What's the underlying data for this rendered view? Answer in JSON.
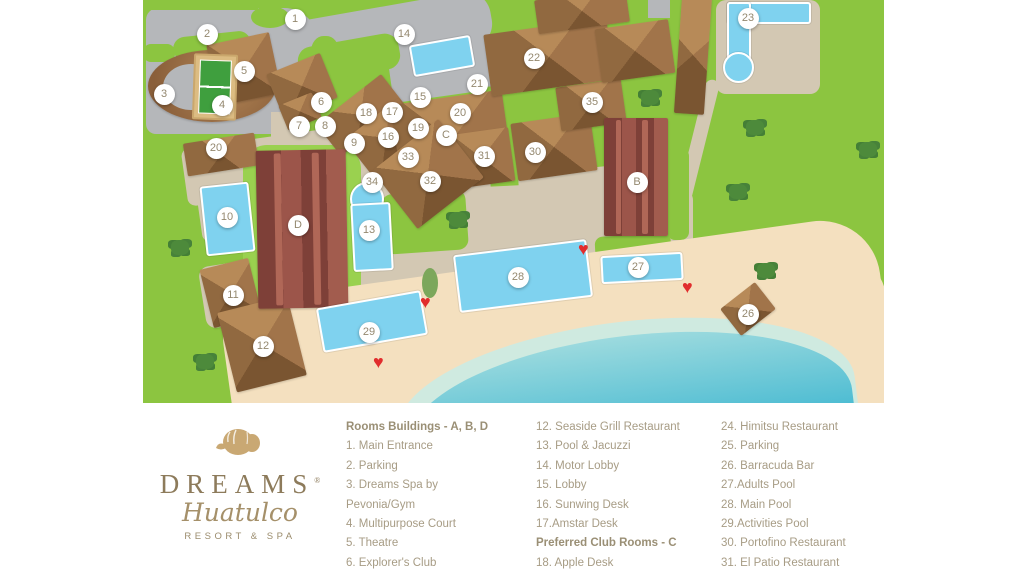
{
  "logo": {
    "brand": "DREAMS",
    "registered": "®",
    "script": "Huatulco",
    "tagline": "RESORT & SPA",
    "shell_icon_color": "#c9a873"
  },
  "legend": {
    "columns": [
      {
        "rows": [
          {
            "t": "h",
            "text": "Rooms Buildings - A, B, D"
          },
          {
            "t": "i",
            "text": "1. Main Entrance"
          },
          {
            "t": "i",
            "text": "2. Parking"
          },
          {
            "t": "i",
            "text": "3. Dreams Spa by"
          },
          {
            "t": "i",
            "text": "Pevonia/Gym"
          },
          {
            "t": "i",
            "text": "4. Multipurpose Court"
          },
          {
            "t": "i",
            "text": "5. Theatre"
          },
          {
            "t": "i",
            "text": "6. Explorer's Club"
          }
        ]
      },
      {
        "rows": [
          {
            "t": "i",
            "text": "12. Seaside Grill Restaurant"
          },
          {
            "t": "i",
            "text": "13. Pool & Jacuzzi"
          },
          {
            "t": "i",
            "text": "14. Motor Lobby"
          },
          {
            "t": "i",
            "text": "15. Lobby"
          },
          {
            "t": "i",
            "text": "16. Sunwing Desk"
          },
          {
            "t": "i",
            "text": "17.Amstar Desk"
          },
          {
            "t": "h",
            "text": "Preferred Club Rooms - C"
          },
          {
            "t": "i",
            "text": "18. Apple Desk"
          },
          {
            "t": "i",
            "text": "19. Rendezvous Bar"
          }
        ]
      },
      {
        "rows": [
          {
            "t": "i",
            "text": "24. Himitsu Restaurant"
          },
          {
            "t": "i",
            "text": "25. Parking"
          },
          {
            "t": "i",
            "text": "26. Barracuda Bar"
          },
          {
            "t": "i",
            "text": "27.Adults Pool"
          },
          {
            "t": "i",
            "text": "28. Main Pool"
          },
          {
            "t": "i",
            "text": "29.Activities Pool"
          },
          {
            "t": "i",
            "text": "30. Portofino Restaurant"
          },
          {
            "t": "i",
            "text": "31. El Patio Restaurant"
          },
          {
            "t": "i",
            "text": "32. World Café Restaurant"
          }
        ]
      }
    ]
  },
  "map": {
    "note": "marker coordinates are relative to map area (left 143, top 0)",
    "markers": [
      {
        "label": "1",
        "x": 152,
        "y": 19
      },
      {
        "label": "2",
        "x": 64,
        "y": 34
      },
      {
        "label": "3",
        "x": 21,
        "y": 94
      },
      {
        "label": "4",
        "x": 79,
        "y": 105
      },
      {
        "label": "5",
        "x": 101,
        "y": 71
      },
      {
        "label": "6",
        "x": 178,
        "y": 102
      },
      {
        "label": "7",
        "x": 156,
        "y": 126
      },
      {
        "label": "8",
        "x": 182,
        "y": 126
      },
      {
        "label": "9",
        "x": 211,
        "y": 143
      },
      {
        "label": "10",
        "x": 84,
        "y": 217
      },
      {
        "label": "11",
        "x": 90,
        "y": 295
      },
      {
        "label": "12",
        "x": 120,
        "y": 346
      },
      {
        "label": "13",
        "x": 226,
        "y": 230
      },
      {
        "label": "14",
        "x": 261,
        "y": 34
      },
      {
        "label": "15",
        "x": 277,
        "y": 97
      },
      {
        "label": "16",
        "x": 245,
        "y": 137
      },
      {
        "label": "17",
        "x": 249,
        "y": 112
      },
      {
        "label": "18",
        "x": 223,
        "y": 113
      },
      {
        "label": "19",
        "x": 275,
        "y": 128
      },
      {
        "label": "20",
        "x": 73,
        "y": 148
      },
      {
        "label": "20",
        "x": 317,
        "y": 113
      },
      {
        "label": "21",
        "x": 334,
        "y": 84
      },
      {
        "label": "22",
        "x": 391,
        "y": 58
      },
      {
        "label": "23",
        "x": 605,
        "y": 18
      },
      {
        "label": "26",
        "x": 605,
        "y": 314
      },
      {
        "label": "27",
        "x": 495,
        "y": 267
      },
      {
        "label": "28",
        "x": 375,
        "y": 277
      },
      {
        "label": "29",
        "x": 226,
        "y": 332
      },
      {
        "label": "30",
        "x": 392,
        "y": 152
      },
      {
        "label": "31",
        "x": 341,
        "y": 156
      },
      {
        "label": "32",
        "x": 287,
        "y": 181
      },
      {
        "label": "33",
        "x": 265,
        "y": 157
      },
      {
        "label": "34",
        "x": 229,
        "y": 182
      },
      {
        "label": "35",
        "x": 449,
        "y": 102
      },
      {
        "label": "B",
        "x": 494,
        "y": 182
      },
      {
        "label": "C",
        "x": 303,
        "y": 135
      },
      {
        "label": "D",
        "x": 155,
        "y": 225
      }
    ],
    "hearts": [
      {
        "x": 286,
        "y": 302
      },
      {
        "x": 239,
        "y": 362
      },
      {
        "x": 444,
        "y": 249
      },
      {
        "x": 548,
        "y": 287
      }
    ],
    "trees": [
      {
        "x": 37,
        "y": 248
      },
      {
        "x": 62,
        "y": 362
      },
      {
        "x": 315,
        "y": 220
      },
      {
        "x": 507,
        "y": 98
      },
      {
        "x": 612,
        "y": 128
      },
      {
        "x": 595,
        "y": 192
      },
      {
        "x": 623,
        "y": 271
      },
      {
        "x": 725,
        "y": 150
      }
    ],
    "colors": {
      "grass": "#8cc540",
      "road": "#b5b7ba",
      "path": "#d3c8b3",
      "sand": "#f4e0bf",
      "ocean": "#4abbd2",
      "pool": "#7fd2ef",
      "roof_brown": "#9c7246",
      "roof_maroon": "#8d4a41",
      "heart": "#e12d2d",
      "marker_text": "#94886f",
      "legend_text": "#a79c85",
      "logo_gold": "#8d7b5b"
    }
  }
}
